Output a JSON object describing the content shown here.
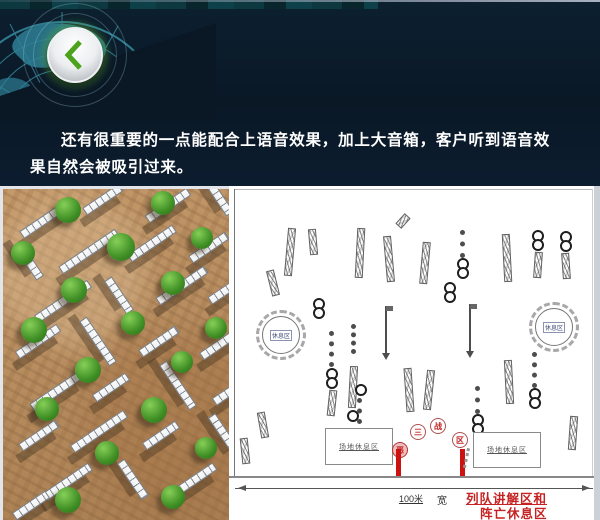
{
  "slide": {
    "paragraph": "还有很重要的一点能配合上语音效果，加上大音箱，客户听到语音效果自然会被吸引过来。"
  },
  "header": {
    "back_button_icon": "chevron-left",
    "button_glow_color": "#4aa31a"
  },
  "colors": {
    "header_navy": "#0a1826",
    "globe_teal": "#3a93a8",
    "annotation_red": "#c62222",
    "pillar_red": "#cc1111",
    "ground_tan": "#b58a5c",
    "wall_grey": "#ccd1d6",
    "bush_green": "#4a9a2c",
    "diagram_bg": "#ffffff"
  },
  "photo": {
    "walls": [
      {
        "x": 14,
        "y": 26,
        "w": 56,
        "r": -34
      },
      {
        "x": 78,
        "y": 6,
        "w": 44,
        "r": -34
      },
      {
        "x": 140,
        "y": 12,
        "w": 50,
        "r": -34
      },
      {
        "x": 196,
        "y": 4,
        "w": 40,
        "r": 56
      },
      {
        "x": 6,
        "y": 68,
        "w": 40,
        "r": 56
      },
      {
        "x": 52,
        "y": 58,
        "w": 68,
        "r": -34
      },
      {
        "x": 122,
        "y": 50,
        "w": 54,
        "r": -34
      },
      {
        "x": 184,
        "y": 54,
        "w": 44,
        "r": -34
      },
      {
        "x": 28,
        "y": 108,
        "w": 64,
        "r": -34
      },
      {
        "x": 96,
        "y": 102,
        "w": 40,
        "r": 56
      },
      {
        "x": 150,
        "y": 92,
        "w": 58,
        "r": -34
      },
      {
        "x": 204,
        "y": 98,
        "w": 34,
        "r": -34
      },
      {
        "x": 10,
        "y": 148,
        "w": 50,
        "r": -34
      },
      {
        "x": 68,
        "y": 148,
        "w": 54,
        "r": 56
      },
      {
        "x": 134,
        "y": 148,
        "w": 44,
        "r": -34
      },
      {
        "x": 194,
        "y": 148,
        "w": 54,
        "r": -34
      },
      {
        "x": 24,
        "y": 198,
        "w": 58,
        "r": -34
      },
      {
        "x": 88,
        "y": 194,
        "w": 40,
        "r": -34
      },
      {
        "x": 148,
        "y": 192,
        "w": 54,
        "r": 56
      },
      {
        "x": 208,
        "y": 198,
        "w": 38,
        "r": -34
      },
      {
        "x": 14,
        "y": 242,
        "w": 44,
        "r": -34
      },
      {
        "x": 64,
        "y": 238,
        "w": 64,
        "r": -34
      },
      {
        "x": 138,
        "y": 242,
        "w": 40,
        "r": -34
      },
      {
        "x": 198,
        "y": 242,
        "w": 48,
        "r": 56
      },
      {
        "x": 38,
        "y": 288,
        "w": 54,
        "r": -34
      },
      {
        "x": 108,
        "y": 286,
        "w": 44,
        "r": 56
      },
      {
        "x": 168,
        "y": 286,
        "w": 48,
        "r": -34
      },
      {
        "x": 8,
        "y": 312,
        "w": 40,
        "r": -34
      }
    ],
    "bushes": [
      {
        "x": 52,
        "y": 8,
        "s": 26
      },
      {
        "x": 148,
        "y": 2,
        "s": 24
      },
      {
        "x": 8,
        "y": 52,
        "s": 24
      },
      {
        "x": 104,
        "y": 44,
        "s": 28
      },
      {
        "x": 188,
        "y": 38,
        "s": 22
      },
      {
        "x": 58,
        "y": 88,
        "s": 26
      },
      {
        "x": 158,
        "y": 82,
        "s": 24
      },
      {
        "x": 18,
        "y": 128,
        "s": 26
      },
      {
        "x": 118,
        "y": 122,
        "s": 24
      },
      {
        "x": 202,
        "y": 128,
        "s": 22
      },
      {
        "x": 72,
        "y": 168,
        "s": 26
      },
      {
        "x": 168,
        "y": 162,
        "s": 22
      },
      {
        "x": 32,
        "y": 208,
        "s": 24
      },
      {
        "x": 138,
        "y": 208,
        "s": 26
      },
      {
        "x": 92,
        "y": 252,
        "s": 24
      },
      {
        "x": 192,
        "y": 248,
        "s": 22
      },
      {
        "x": 52,
        "y": 298,
        "s": 26
      },
      {
        "x": 158,
        "y": 296,
        "s": 24
      }
    ]
  },
  "diagram": {
    "left_box_label": "场地休息区",
    "right_box_label": "场地休息区",
    "dimension_label": "100米",
    "width_word": "宽",
    "annotation_line1": "列队讲解区和",
    "annotation_line2": "阵亡休息区",
    "gate": {
      "circles": [
        {
          "x": 163,
          "y": 256,
          "ch": "恶",
          "red": true
        },
        {
          "x": 181,
          "y": 238,
          "ch": "三",
          "red": false
        },
        {
          "x": 201,
          "y": 232,
          "ch": "战",
          "red": false
        },
        {
          "x": 223,
          "y": 246,
          "ch": "区",
          "red": false
        }
      ],
      "pillars": [
        {
          "x": 167
        },
        {
          "x": 231
        }
      ]
    },
    "elements": [
      {
        "t": "wall",
        "x": 40,
        "y": 84,
        "h": 26,
        "r": -14
      },
      {
        "t": "wall",
        "x": 57,
        "y": 42,
        "h": 48,
        "r": 5
      },
      {
        "t": "wall",
        "x": 80,
        "y": 43,
        "h": 26,
        "r": -5
      },
      {
        "t": "rings",
        "x": 84,
        "y": 112,
        "n": 2
      },
      {
        "t": "wall",
        "x": 127,
        "y": 42,
        "h": 50,
        "r": 3
      },
      {
        "t": "wall",
        "x": 156,
        "y": 50,
        "h": 46,
        "r": -5
      },
      {
        "t": "wall",
        "x": 170,
        "y": 28,
        "h": 14,
        "r": 42
      },
      {
        "t": "wall",
        "x": 192,
        "y": 56,
        "h": 42,
        "r": 5
      },
      {
        "t": "rings",
        "x": 215,
        "y": 96,
        "n": 2
      },
      {
        "t": "chain",
        "x": 231,
        "y": 44,
        "h": 28
      },
      {
        "t": "rings",
        "x": 228,
        "y": 72,
        "n": 2
      },
      {
        "t": "wall",
        "x": 274,
        "y": 48,
        "h": 48,
        "r": -3
      },
      {
        "t": "rings",
        "x": 303,
        "y": 44,
        "n": 2
      },
      {
        "t": "wall",
        "x": 305,
        "y": 66,
        "h": 26,
        "r": 4
      },
      {
        "t": "rings",
        "x": 331,
        "y": 45,
        "n": 2
      },
      {
        "t": "wall",
        "x": 333,
        "y": 67,
        "h": 26,
        "r": -4
      },
      {
        "t": "table",
        "x": 33,
        "y": 130,
        "label": "休息区"
      },
      {
        "t": "chain",
        "x": 100,
        "y": 145,
        "h": 36
      },
      {
        "t": "rings",
        "x": 97,
        "y": 182,
        "n": 2
      },
      {
        "t": "wall",
        "x": 99,
        "y": 204,
        "h": 26,
        "r": 6
      },
      {
        "t": "wall",
        "x": 30,
        "y": 226,
        "h": 26,
        "r": -10
      },
      {
        "t": "chain",
        "x": 122,
        "y": 138,
        "h": 30
      },
      {
        "t": "wall",
        "x": 120,
        "y": 180,
        "h": 42,
        "r": 3
      },
      {
        "t": "rings",
        "x": 118,
        "y": 224,
        "n": 1
      },
      {
        "t": "pole",
        "x": 156,
        "y": 120,
        "h": 52
      },
      {
        "t": "wall",
        "x": 176,
        "y": 182,
        "h": 44,
        "r": -4
      },
      {
        "t": "wall",
        "x": 196,
        "y": 184,
        "h": 40,
        "r": 6
      },
      {
        "t": "pole",
        "x": 240,
        "y": 118,
        "h": 52
      },
      {
        "t": "chain",
        "x": 246,
        "y": 200,
        "h": 28
      },
      {
        "t": "rings",
        "x": 243,
        "y": 228,
        "n": 2
      },
      {
        "t": "wall",
        "x": 276,
        "y": 174,
        "h": 44,
        "r": -3
      },
      {
        "t": "chain",
        "x": 303,
        "y": 166,
        "h": 36
      },
      {
        "t": "rings",
        "x": 300,
        "y": 202,
        "n": 2
      },
      {
        "t": "table",
        "x": 306,
        "y": 122,
        "label": "休息区"
      },
      {
        "t": "wall",
        "x": 340,
        "y": 230,
        "h": 34,
        "r": 4
      },
      {
        "t": "wall",
        "x": 12,
        "y": 252,
        "h": 26,
        "r": -6
      },
      {
        "t": "rings",
        "x": 126,
        "y": 198,
        "n": 1
      },
      {
        "t": "chain",
        "x": 128,
        "y": 212,
        "h": 26
      }
    ]
  }
}
